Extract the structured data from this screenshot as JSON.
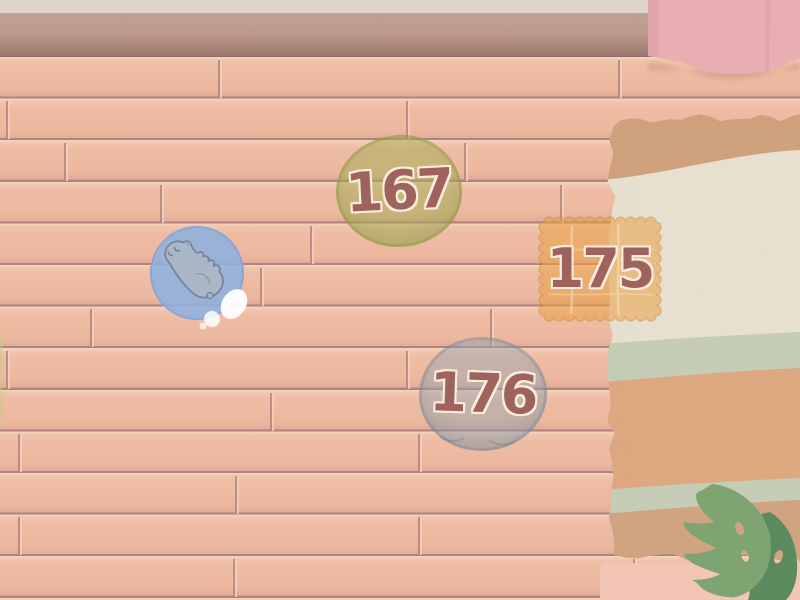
{
  "items": [
    {
      "name": "round-green-cushion",
      "label": "167",
      "fill": "#a7ae58"
    },
    {
      "name": "square-cracker-mat",
      "label": "175",
      "fill": "#e9a046"
    },
    {
      "name": "round-gray-cushion",
      "label": "176",
      "fill": "#94a6b4"
    },
    {
      "name": "hamster-bubble",
      "label": "",
      "fill": "#8fb1de"
    }
  ],
  "palette": {
    "floor_plank": "#eebca4",
    "floor_seam": "#b3867f",
    "floor_highlight": "#f6d5bf",
    "wall_upper": "#ded4c7",
    "wall_baseboard": "#bd9e91",
    "wall_baseboard_dark": "#8f6a63",
    "curtain": "#e8aeb2",
    "pink_mat": "#f2c5b4",
    "rug_bands": [
      "#d0a17c",
      "#e9e2d3",
      "#c6ceb8",
      "#dfa87f",
      "#c6ceb8",
      "#d2a480"
    ],
    "leaf_light": "#7ea571",
    "leaf_dark": "#5c8a5f",
    "bubble_blue": "#8fb1de",
    "hamster_gray": "#aab7c7",
    "number_color": "#9d635c",
    "number_outline": "#faeddd"
  },
  "floor": {
    "row_height": 41.6,
    "first_row_y": 58,
    "joints": [
      {
        "row": 0,
        "xs": [
          218,
          618
        ]
      },
      {
        "row": 1,
        "xs": [
          6,
          406
        ]
      },
      {
        "row": 2,
        "xs": [
          64,
          464
        ]
      },
      {
        "row": 3,
        "xs": [
          160,
          560
        ]
      },
      {
        "row": 4,
        "xs": [
          310,
          710
        ]
      },
      {
        "row": 5,
        "xs": [
          260,
          660
        ]
      },
      {
        "row": 6,
        "xs": [
          90,
          490
        ]
      },
      {
        "row": 7,
        "xs": [
          6,
          406
        ]
      },
      {
        "row": 8,
        "xs": [
          270,
          670
        ]
      },
      {
        "row": 9,
        "xs": [
          18,
          418
        ]
      },
      {
        "row": 10,
        "xs": [
          235,
          635
        ]
      },
      {
        "row": 11,
        "xs": [
          18,
          418
        ]
      },
      {
        "row": 12,
        "xs": [
          233,
          633
        ]
      }
    ]
  }
}
